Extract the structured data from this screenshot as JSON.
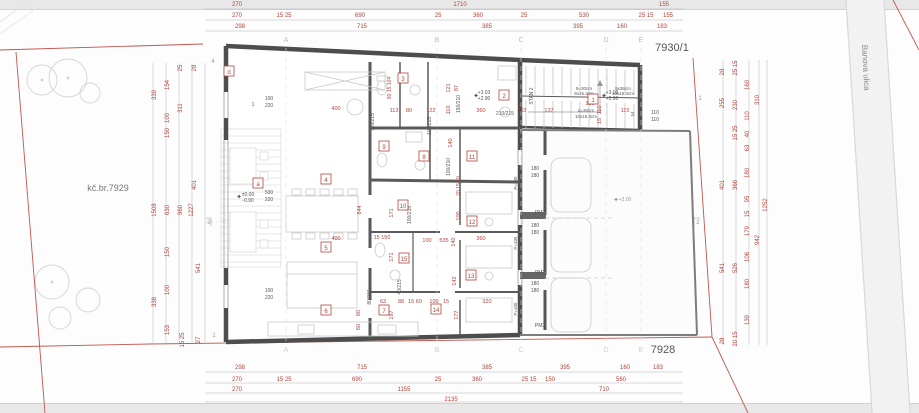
{
  "colors": {
    "red": "#b2443c",
    "dark": "#555555",
    "gray": "#9a9a9a",
    "light": "#bdbdbd"
  },
  "parcels": {
    "left": "kč.br.7929",
    "top_right": "7930/1",
    "bottom_right": "7928"
  },
  "street": {
    "name": "Banova ulica"
  },
  "grid": {
    "letters": [
      "A",
      "B",
      "C",
      "D",
      "E"
    ],
    "x": [
      286,
      437,
      521,
      606,
      641
    ],
    "top_y": 42,
    "bottom_y": 352
  },
  "rooms": [
    {
      "id": "d",
      "x": 229,
      "y": 73
    },
    {
      "id": "a",
      "x": 258,
      "y": 185
    },
    {
      "id": "1",
      "x": 593,
      "y": 101
    },
    {
      "id": "2",
      "x": 504,
      "y": 97
    },
    {
      "id": "3",
      "x": 403,
      "y": 80
    },
    {
      "id": "4",
      "x": 326,
      "y": 181
    },
    {
      "id": "5",
      "x": 326,
      "y": 249
    },
    {
      "id": "6",
      "x": 326,
      "y": 312
    },
    {
      "id": "7",
      "x": 384,
      "y": 312
    },
    {
      "id": "8",
      "x": 424,
      "y": 158
    },
    {
      "id": "9",
      "x": 384,
      "y": 148
    },
    {
      "id": "10",
      "x": 403,
      "y": 207
    },
    {
      "id": "11",
      "x": 472,
      "y": 158
    },
    {
      "id": "12",
      "x": 472,
      "y": 223
    },
    {
      "id": "13",
      "x": 471,
      "y": 277
    },
    {
      "id": "14",
      "x": 436,
      "y": 311
    },
    {
      "id": "15",
      "x": 404,
      "y": 260
    }
  ],
  "texts": {
    "format": [
      "text",
      "x",
      "y",
      "rot",
      "color",
      "size"
    ],
    "items": [
      [
        "270",
        237,
        6
      ],
      [
        "1710",
        460,
        6
      ],
      [
        "155",
        664,
        6
      ],
      [
        "270",
        237,
        17
      ],
      [
        "15 25",
        284,
        17
      ],
      [
        "690",
        360,
        17
      ],
      [
        "25",
        438,
        17
      ],
      [
        "360",
        478,
        17
      ],
      [
        "25",
        524,
        17
      ],
      [
        "530",
        584,
        17
      ],
      [
        "25 15",
        646,
        17
      ],
      [
        "155",
        668,
        17
      ],
      [
        "298",
        240,
        28
      ],
      [
        "715",
        362,
        28
      ],
      [
        "385",
        487,
        28
      ],
      [
        "395",
        578,
        28
      ],
      [
        "160",
        622,
        28
      ],
      [
        "183",
        662,
        28
      ],
      [
        "298",
        240,
        369
      ],
      [
        "715",
        362,
        369
      ],
      [
        "385",
        487,
        369
      ],
      [
        "395",
        565,
        369
      ],
      [
        "160",
        625,
        369
      ],
      [
        "183",
        658,
        369
      ],
      [
        "270",
        237,
        381
      ],
      [
        "15 25",
        284,
        381
      ],
      [
        "690",
        357,
        381
      ],
      [
        "25",
        438,
        381
      ],
      [
        "360",
        477,
        381
      ],
      [
        "25 15",
        529,
        381
      ],
      [
        "150",
        550,
        381
      ],
      [
        "560",
        621,
        381
      ],
      [
        "270",
        237,
        391
      ],
      [
        "1155",
        404,
        391
      ],
      [
        "710",
        604,
        391
      ],
      [
        "2135",
        451,
        401
      ],
      [
        "339",
        156,
        95,
        -90
      ],
      [
        "1508",
        156,
        210,
        -90
      ],
      [
        "338",
        156,
        302,
        -90
      ],
      [
        "154",
        169,
        85,
        -90
      ],
      [
        "100",
        169,
        118,
        -90
      ],
      [
        "150",
        169,
        133,
        -90
      ],
      [
        "630",
        169,
        210,
        -90
      ],
      [
        "150",
        169,
        252,
        -90
      ],
      [
        "100",
        169,
        290,
        -90
      ],
      [
        "153",
        169,
        330,
        -90
      ],
      [
        "25",
        182,
        68,
        -90
      ],
      [
        "311",
        182,
        108,
        -90
      ],
      [
        "960",
        182,
        210,
        -90
      ],
      [
        "15 25",
        184,
        340,
        -90
      ],
      [
        "28",
        196,
        68,
        -90
      ],
      [
        "401",
        196,
        185,
        -90
      ],
      [
        "1227",
        193,
        210,
        -90
      ],
      [
        "541",
        200,
        268,
        -90
      ],
      [
        "27",
        200,
        340,
        -90
      ],
      [
        "28",
        724,
        72,
        -90
      ],
      [
        "255",
        724,
        103,
        -90
      ],
      [
        "401",
        724,
        185,
        -90
      ],
      [
        "541",
        724,
        268,
        -90
      ],
      [
        "28",
        724,
        341,
        -90
      ],
      [
        "25 15",
        737,
        68,
        -90
      ],
      [
        "230",
        737,
        105,
        -90
      ],
      [
        "15 25",
        737,
        133,
        -90
      ],
      [
        "366",
        737,
        185,
        -90
      ],
      [
        "526",
        737,
        268,
        -90
      ],
      [
        "20 15",
        737,
        339,
        -90
      ],
      [
        "160",
        749,
        85,
        -90
      ],
      [
        "110",
        749,
        116,
        -90
      ],
      [
        "40",
        749,
        134,
        -90
      ],
      [
        "63",
        749,
        148,
        -90
      ],
      [
        "180",
        749,
        173,
        -90
      ],
      [
        "95",
        749,
        199,
        -90
      ],
      [
        "15",
        749,
        214,
        -90
      ],
      [
        "179",
        749,
        231,
        -90
      ],
      [
        "106",
        749,
        257,
        -90
      ],
      [
        "180",
        749,
        284,
        -90
      ],
      [
        "139",
        749,
        320,
        -90
      ],
      [
        "310",
        759,
        100,
        -90
      ],
      [
        "942",
        759,
        240,
        -90
      ],
      [
        "1252",
        767,
        205,
        -90
      ],
      [
        "400",
        336,
        110,
        0,
        "red",
        5.5
      ],
      [
        "113",
        394,
        112,
        0,
        "red",
        5.5
      ],
      [
        "80",
        409,
        112,
        0,
        "red",
        5.5
      ],
      [
        "122",
        431,
        112,
        0,
        "red",
        5.5
      ],
      [
        "360",
        481,
        112,
        0,
        "red",
        5.5
      ],
      [
        "33",
        523,
        112,
        0,
        "red",
        5.5
      ],
      [
        "137",
        549,
        112,
        0,
        "red",
        5.5
      ],
      [
        "115",
        625,
        112,
        0,
        "red",
        5.5
      ],
      [
        "130",
        590,
        105,
        0,
        "red",
        5.5
      ],
      [
        "121",
        450,
        88,
        -90,
        "red",
        5.5
      ],
      [
        "87",
        458,
        88,
        -90,
        "red",
        5.5
      ],
      [
        "110",
        450,
        110,
        -90,
        "red",
        5.5
      ],
      [
        "140",
        452,
        143,
        -90,
        "red",
        5.5
      ],
      [
        "110",
        601,
        110,
        -90,
        "red",
        5.5
      ],
      [
        "15",
        601,
        121,
        -90,
        "red",
        5.5
      ],
      [
        "90 15 104",
        391,
        88,
        -90,
        "red",
        5
      ],
      [
        "844",
        361,
        210,
        -90,
        "red",
        5.5
      ],
      [
        "171",
        393,
        213,
        -90,
        "red",
        5.5
      ],
      [
        "171",
        393,
        257,
        -90,
        "red",
        5.5
      ],
      [
        "100",
        460,
        216,
        -90,
        "red",
        5.5
      ],
      [
        "70 15 70",
        460,
        186,
        -90,
        "red",
        5
      ],
      [
        "400",
        336,
        240,
        0,
        "red",
        5.5
      ],
      [
        "15 150",
        382,
        239,
        0,
        "red",
        5.5
      ],
      [
        "100",
        427,
        242,
        0,
        "red",
        5.5
      ],
      [
        "535",
        444,
        242,
        0,
        "red",
        5.5
      ],
      [
        "140",
        455,
        242,
        -90,
        "red",
        5.5
      ],
      [
        "360",
        481,
        240,
        0,
        "red",
        5.5
      ],
      [
        "63",
        383,
        303,
        0,
        "red",
        5.5
      ],
      [
        "88",
        401,
        303,
        0,
        "red",
        5.5
      ],
      [
        "15 60",
        415,
        303,
        0,
        "red",
        5.5
      ],
      [
        "100",
        434,
        303,
        0,
        "red",
        5.5
      ],
      [
        "15",
        446,
        303,
        0,
        "red",
        5.5
      ],
      [
        "320",
        487,
        303,
        0,
        "red",
        5.5
      ],
      [
        "142",
        456,
        281,
        -90,
        "red",
        5.5
      ],
      [
        "177",
        458,
        315,
        -90,
        "red",
        5.5
      ],
      [
        "197",
        393,
        315,
        -90,
        "red",
        5.5
      ],
      [
        "80",
        360,
        313,
        -90,
        "red",
        5.5
      ],
      [
        "60",
        360,
        327,
        -90,
        "red",
        5.5
      ],
      [
        "150/210",
        460,
        104,
        -90,
        "dark",
        5
      ],
      [
        "110/215",
        374,
        122,
        -90,
        "dark",
        5
      ],
      [
        "210/215",
        505,
        115,
        0,
        "dark",
        5
      ],
      [
        "100/215",
        431,
        126,
        -90,
        "dark",
        5
      ],
      [
        "100/210",
        450,
        167,
        -90,
        "dark",
        5
      ],
      [
        "100/215",
        411,
        215,
        -90,
        "dark",
        5
      ],
      [
        "80/215",
        371,
        297,
        -90,
        "dark",
        5
      ],
      [
        "40/215",
        401,
        287,
        -90,
        "dark",
        5
      ],
      [
        "100",
        269,
        100,
        0,
        "dark",
        5
      ],
      [
        "220",
        269,
        107,
        0,
        "dark",
        5
      ],
      [
        "500",
        269,
        194,
        0,
        "dark",
        5
      ],
      [
        "220",
        269,
        201,
        0,
        "dark",
        5
      ],
      [
        "100",
        269,
        292,
        0,
        "dark",
        5
      ],
      [
        "220",
        269,
        299,
        0,
        "dark",
        5
      ],
      [
        "1",
        253,
        106,
        0,
        "dark",
        5
      ],
      [
        "180",
        535,
        170,
        0,
        "dark",
        5
      ],
      [
        "180",
        535,
        177,
        0,
        "dark",
        5
      ],
      [
        "180",
        535,
        227,
        0,
        "dark",
        5
      ],
      [
        "180",
        535,
        234,
        0,
        "dark",
        5
      ],
      [
        "180",
        535,
        285,
        0,
        "dark",
        5
      ],
      [
        "180",
        535,
        292,
        0,
        "dark",
        5
      ],
      [
        "110",
        655,
        114,
        0,
        "dark",
        5
      ],
      [
        "110",
        655,
        121,
        0,
        "dark",
        5
      ],
      [
        "PM1",
        540,
        214,
        0,
        "dark",
        5
      ],
      [
        "PM2",
        540,
        274,
        0,
        "dark",
        5
      ],
      [
        "PM3",
        540,
        327,
        0,
        "dark",
        5
      ],
      [
        "P=195",
        517,
        183,
        -90,
        "dark",
        4.5
      ],
      [
        "P=105",
        517,
        243,
        -90,
        "dark",
        4.5
      ],
      [
        "P=105",
        517,
        309,
        -90,
        "dark",
        4.5
      ],
      [
        "STAN 2",
        533,
        96,
        -90,
        "dark",
        5
      ],
      [
        "9=30cm",
        584,
        90,
        0,
        "dark",
        4.5
      ],
      [
        "9x15.3cm",
        584,
        95,
        0,
        "dark",
        4.5
      ],
      [
        "9x36cm",
        623,
        90,
        0,
        "dark",
        4.5
      ],
      [
        "10x15.3cm",
        623,
        95,
        0,
        "dark",
        4.5
      ],
      [
        "d=30cm",
        586,
        112,
        0,
        "dark",
        4.5
      ],
      [
        "10x15.3cm",
        586,
        118,
        0,
        "dark",
        4.5
      ],
      [
        "54",
        634,
        114,
        -90,
        "dark",
        4.5
      ],
      [
        "+3.03",
        484,
        94,
        0,
        "dark",
        5
      ],
      [
        "+2.90",
        484,
        100,
        0,
        "dark",
        5
      ],
      [
        "✦",
        476,
        98,
        0,
        "dark",
        7
      ],
      [
        "+3.03",
        612,
        94,
        0,
        "dark",
        5
      ],
      [
        "+2.90",
        612,
        100,
        0,
        "dark",
        5
      ],
      [
        "✦",
        604,
        98,
        0,
        "dark",
        7
      ],
      [
        "+3.00",
        625,
        201,
        0,
        "gray",
        5
      ],
      [
        "✦",
        616,
        202,
        0,
        "gray",
        7
      ],
      [
        "±0.00",
        248,
        196,
        0,
        "dark",
        5
      ],
      [
        "-0.90",
        248,
        202,
        0,
        "dark",
        5
      ],
      [
        "✦",
        239,
        199,
        0,
        "dark",
        7
      ],
      [
        "2",
        209,
        224,
        0,
        "gray",
        6
      ],
      [
        "2",
        698,
        224,
        0,
        "gray",
        6
      ],
      [
        "1",
        700,
        100,
        0,
        "gray",
        6
      ],
      [
        "1",
        214,
        337,
        0,
        "gray",
        6
      ],
      [
        "4",
        213,
        63,
        0,
        "gray",
        6
      ]
    ]
  }
}
